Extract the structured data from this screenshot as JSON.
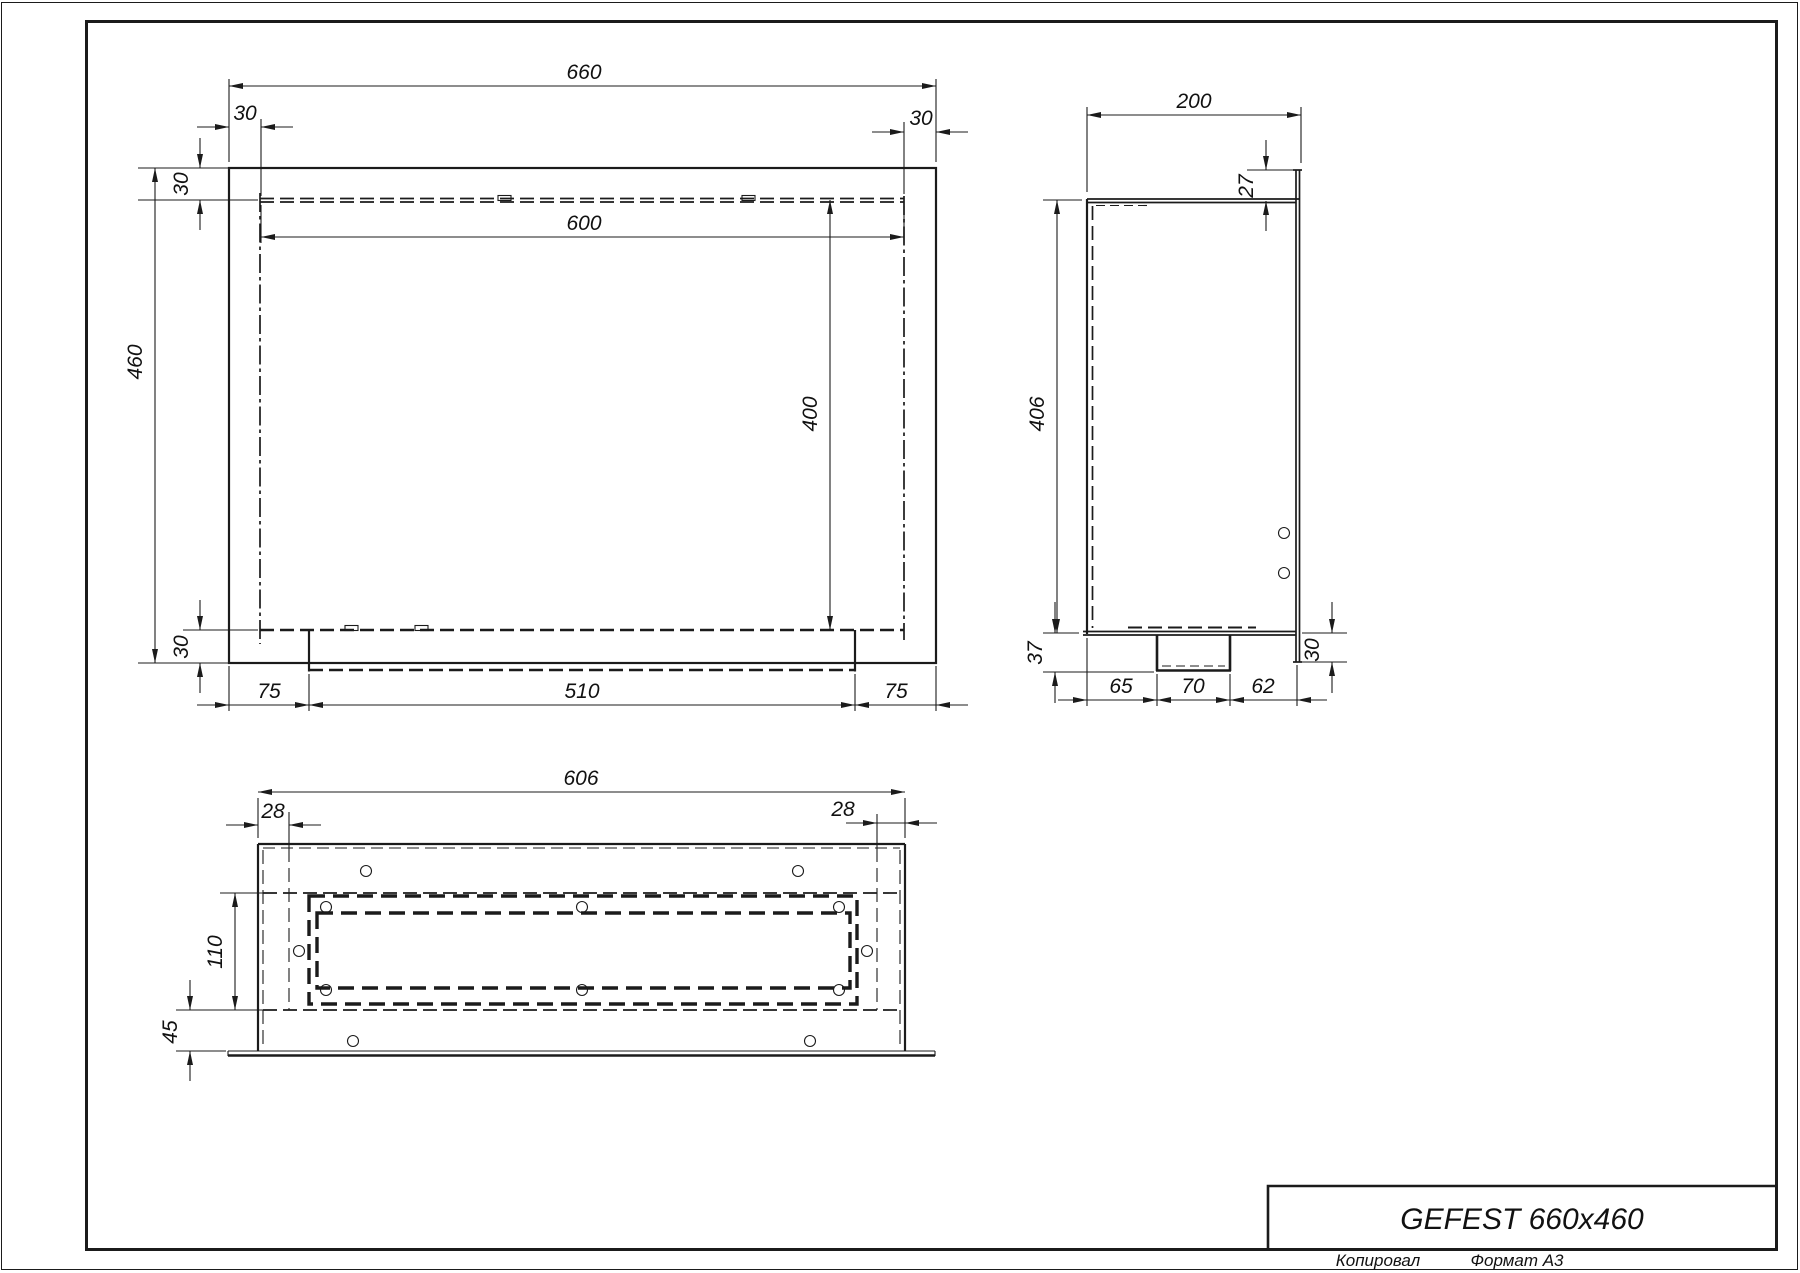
{
  "drawing": {
    "title": "GEFEST 660x460",
    "footer": {
      "copied": "Копировал",
      "format": "Формат А3"
    }
  },
  "front_view": {
    "dims": {
      "total_width": "660",
      "inner_width": "600",
      "inset_left": "30",
      "inset_right": "30",
      "inset_top": "30",
      "inset_bottom": "30",
      "total_height": "460",
      "inner_height": "400",
      "margin_left": "75",
      "burner_width": "510",
      "margin_right": "75"
    }
  },
  "side_view": {
    "dims": {
      "depth": "200",
      "flange_top_offset": "27",
      "body_height": "406",
      "burner_drop": "37",
      "seg_left": "65",
      "seg_center": "70",
      "seg_right": "62",
      "flange_bottom_offset": "30"
    }
  },
  "bottom_view": {
    "dims": {
      "body_width": "606",
      "inset_left": "28",
      "inset_right": "28",
      "slot_height": "110",
      "flange_height": "45"
    }
  },
  "colors": {
    "line": "#1b1b1b",
    "background": "#ffffff"
  }
}
